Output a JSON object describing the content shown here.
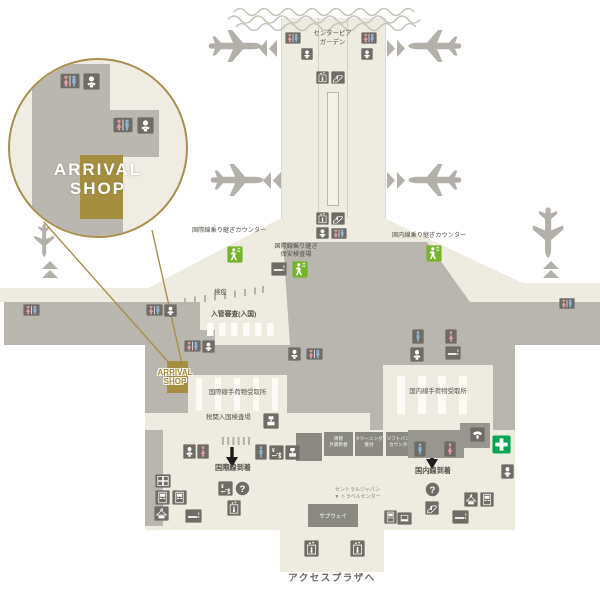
{
  "callout": {
    "shop_line1": "ARRIVAL",
    "shop_line2": "SHOP"
  },
  "map_shop_label": {
    "line1": "ARRIVAL",
    "line2": "SHOP"
  },
  "labels": {
    "center_pier_garden_1": "センターピア",
    "center_pier_garden_2": "ガーデン",
    "intl_transfer_counter": "国際線乗り継ぎカウンター",
    "intl_transfer_security_1": "国際線乗り継ぎ",
    "intl_transfer_security_2": "保安検査場",
    "dom_transfer_counter": "国内線乗り継ぎカウンター",
    "quarantine": "検疫",
    "immigration": "入管審査(入国)",
    "intl_baggage_claim": "国際線手荷物受取所",
    "dom_baggage_claim": "国内線手荷物受取所",
    "customs_inspection": "税関入国検査場",
    "intl_arrivals": "国際線到着",
    "dom_arrivals": "国内線到着",
    "central_japan_1": "セントラルジャパン",
    "central_japan_2": "▼ トラベルセンター",
    "access_plaza": "アクセスプラザへ"
  },
  "services": {
    "subway": "サブウェイ",
    "exchange_1": "両替",
    "exchange_2": "外貨両替",
    "cleaning_1": "クリーニング",
    "cleaning_2": "受付",
    "softbank_1": "ソフトバンク",
    "softbank_2": "カウンター"
  },
  "colors": {
    "accent_gold": "#a8904a",
    "terminal_cream": "#eeece1",
    "secure_gray": "#b8b6ae",
    "icon_gray": "#6e6c65",
    "service_box_gray": "#8b8a82",
    "walk_green": "#76b42c",
    "first_aid_green": "#00a651",
    "female_pink": "#e39aa6",
    "male_blue": "#8fb6d9",
    "label_text": "#55534b"
  },
  "map": {
    "icons": [
      {
        "name": "pier-left-restroom",
        "type": "restroom",
        "x": 285,
        "y": 31,
        "w": 16,
        "h": 14,
        "parent": "map"
      },
      {
        "name": "pier-left-baby",
        "type": "baby",
        "x": 301,
        "y": 48,
        "w": 12,
        "h": 12,
        "parent": "map"
      },
      {
        "name": "pier-right-restroom",
        "type": "restroom",
        "x": 361,
        "y": 31,
        "w": 16,
        "h": 14,
        "parent": "map"
      },
      {
        "name": "pier-right-baby",
        "type": "baby",
        "x": 361,
        "y": 48,
        "w": 12,
        "h": 12,
        "parent": "map"
      },
      {
        "name": "corridor-elevator-upper",
        "type": "elevator",
        "x": 316,
        "y": 71,
        "w": 13,
        "h": 13,
        "parent": "map"
      },
      {
        "name": "corridor-escalator-upper",
        "type": "escalator",
        "x": 331,
        "y": 71,
        "w": 14,
        "h": 13,
        "parent": "map"
      },
      {
        "name": "corridor-elevator-lower",
        "type": "elevator",
        "x": 316,
        "y": 212,
        "w": 13,
        "h": 13,
        "parent": "map"
      },
      {
        "name": "corridor-escalator-lower",
        "type": "escalator",
        "x": 331,
        "y": 212,
        "w": 14,
        "h": 13,
        "parent": "map"
      },
      {
        "name": "corridor-baby-lower",
        "type": "baby",
        "x": 316,
        "y": 227,
        "w": 13,
        "h": 12,
        "parent": "map"
      },
      {
        "name": "corridor-restroom-lower",
        "type": "restroom",
        "x": 331,
        "y": 227,
        "w": 16,
        "h": 13,
        "parent": "map"
      },
      {
        "name": "intl-transfer-walk",
        "type": "walk",
        "x": 227,
        "y": 246,
        "w": 16,
        "h": 17,
        "parent": "map"
      },
      {
        "name": "security-smoking",
        "type": "smoking",
        "x": 271,
        "y": 262,
        "w": 16,
        "h": 14,
        "parent": "map"
      },
      {
        "name": "security-walk",
        "type": "walk",
        "x": 292,
        "y": 261,
        "w": 16,
        "h": 17,
        "parent": "map"
      },
      {
        "name": "dom-transfer-walk",
        "type": "walk",
        "x": 426,
        "y": 245,
        "w": 16,
        "h": 17,
        "parent": "map"
      },
      {
        "name": "west-wing-restroom",
        "type": "restroom",
        "x": 23,
        "y": 303,
        "w": 17,
        "h": 14,
        "parent": "map"
      },
      {
        "name": "west-restroom-2",
        "type": "restroom",
        "x": 146,
        "y": 303,
        "w": 17,
        "h": 14,
        "parent": "map"
      },
      {
        "name": "west-baby",
        "type": "baby",
        "x": 164,
        "y": 304,
        "w": 13,
        "h": 13,
        "parent": "map"
      },
      {
        "name": "east-wing-restroom",
        "type": "restroom",
        "x": 559,
        "y": 297,
        "w": 16,
        "h": 13,
        "parent": "map"
      },
      {
        "name": "shop-restroom",
        "type": "restroom",
        "x": 184,
        "y": 339,
        "w": 17,
        "h": 14,
        "parent": "map"
      },
      {
        "name": "shop-baby",
        "type": "baby",
        "x": 202,
        "y": 340,
        "w": 13,
        "h": 13,
        "parent": "map"
      },
      {
        "name": "intl-bag-baby",
        "type": "baby",
        "x": 288,
        "y": 347,
        "w": 13,
        "h": 14,
        "parent": "map"
      },
      {
        "name": "intl-bag-restroom",
        "type": "restroom",
        "x": 306,
        "y": 347,
        "w": 17,
        "h": 14,
        "parent": "map"
      },
      {
        "name": "dom-bag-male",
        "type": "male",
        "x": 412,
        "y": 329,
        "w": 12,
        "h": 15,
        "parent": "map"
      },
      {
        "name": "dom-bag-female",
        "type": "female",
        "x": 445,
        "y": 329,
        "w": 12,
        "h": 15,
        "parent": "map"
      },
      {
        "name": "dom-bag-baby",
        "type": "baby",
        "x": 410,
        "y": 347,
        "w": 14,
        "h": 15,
        "parent": "map"
      },
      {
        "name": "dom-bag-smoking",
        "type": "smoking",
        "x": 445,
        "y": 346,
        "w": 16,
        "h": 14,
        "parent": "map"
      },
      {
        "name": "customs-stamp",
        "type": "customs",
        "x": 263,
        "y": 413,
        "w": 16,
        "h": 16,
        "parent": "map"
      },
      {
        "name": "customs-baby",
        "type": "baby",
        "x": 183,
        "y": 444,
        "w": 13,
        "h": 15,
        "parent": "map"
      },
      {
        "name": "customs-female",
        "type": "female",
        "x": 197,
        "y": 444,
        "w": 12,
        "h": 15,
        "parent": "map"
      },
      {
        "name": "arrivals-male",
        "type": "male",
        "x": 255,
        "y": 444,
        "w": 12,
        "h": 16,
        "parent": "map"
      },
      {
        "name": "arrivals-forex",
        "type": "forex",
        "x": 269,
        "y": 445,
        "w": 15,
        "h": 15,
        "parent": "map"
      },
      {
        "name": "arrivals-customs",
        "type": "customs",
        "x": 285,
        "y": 445,
        "w": 15,
        "h": 15,
        "parent": "map"
      },
      {
        "name": "dom-box-male",
        "type": "male",
        "x": 414,
        "y": 441,
        "w": 12,
        "h": 16,
        "parent": "map"
      },
      {
        "name": "dom-box-female",
        "type": "female",
        "x": 444,
        "y": 441,
        "w": 12,
        "h": 16,
        "parent": "map"
      },
      {
        "name": "public-phone",
        "type": "phone",
        "x": 470,
        "y": 427,
        "w": 15,
        "h": 15,
        "parent": "map"
      },
      {
        "name": "first-aid",
        "type": "firstaid",
        "x": 492,
        "y": 435,
        "w": 19,
        "h": 19,
        "parent": "map"
      },
      {
        "name": "dom-baby",
        "type": "baby",
        "x": 501,
        "y": 464,
        "w": 13,
        "h": 15,
        "parent": "map"
      },
      {
        "name": "intl-forex",
        "type": "forex",
        "x": 218,
        "y": 481,
        "w": 15,
        "h": 15,
        "parent": "map"
      },
      {
        "name": "intl-question",
        "type": "question",
        "x": 235,
        "y": 481,
        "w": 15,
        "h": 15,
        "parent": "map"
      },
      {
        "name": "intl-elevator",
        "type": "elevator",
        "x": 227,
        "y": 500,
        "w": 14,
        "h": 16,
        "parent": "map"
      },
      {
        "name": "dom-question",
        "type": "question",
        "x": 425,
        "y": 482,
        "w": 15,
        "h": 15,
        "parent": "map"
      },
      {
        "name": "dom-escalator",
        "type": "escalator",
        "x": 425,
        "y": 501,
        "w": 14,
        "h": 14,
        "parent": "map"
      },
      {
        "name": "cloak-east",
        "type": "cloak",
        "x": 464,
        "y": 492,
        "w": 14,
        "h": 15,
        "parent": "map"
      },
      {
        "name": "copy-east",
        "type": "vending",
        "x": 480,
        "y": 492,
        "w": 14,
        "h": 15,
        "parent": "map"
      },
      {
        "name": "smoking-east",
        "type": "smoking",
        "x": 452,
        "y": 510,
        "w": 17,
        "h": 14,
        "parent": "map"
      },
      {
        "name": "internet-laptop",
        "type": "laptop",
        "x": 397,
        "y": 512,
        "w": 15,
        "h": 13,
        "parent": "map"
      },
      {
        "name": "vending-east",
        "type": "vending",
        "x": 384,
        "y": 510,
        "w": 13,
        "h": 14,
        "parent": "map"
      },
      {
        "name": "lockers-west",
        "type": "lockers",
        "x": 155,
        "y": 474,
        "w": 16,
        "h": 14,
        "parent": "map"
      },
      {
        "name": "vending-west-1",
        "type": "vending",
        "x": 155,
        "y": 490,
        "w": 15,
        "h": 15,
        "parent": "map"
      },
      {
        "name": "vending-west-2",
        "type": "vending",
        "x": 172,
        "y": 490,
        "w": 15,
        "h": 15,
        "parent": "map"
      },
      {
        "name": "cloak-west",
        "type": "cloak",
        "x": 154,
        "y": 506,
        "w": 15,
        "h": 15,
        "parent": "map"
      },
      {
        "name": "smoking-west",
        "type": "smoking",
        "x": 185,
        "y": 509,
        "w": 17,
        "h": 14,
        "parent": "map"
      },
      {
        "name": "tongue-elevator-1",
        "type": "elevator",
        "x": 304,
        "y": 540,
        "w": 15,
        "h": 17,
        "parent": "map"
      },
      {
        "name": "tongue-elevator-2",
        "type": "elevator",
        "x": 350,
        "y": 540,
        "w": 15,
        "h": 17,
        "parent": "map"
      },
      {
        "name": "callout-restroom-1",
        "type": "restroom",
        "x": 50,
        "y": 12,
        "w": 20,
        "h": 18,
        "parent": "callout"
      },
      {
        "name": "callout-baby-1",
        "type": "baby",
        "x": 73,
        "y": 13,
        "w": 17,
        "h": 17,
        "parent": "callout"
      },
      {
        "name": "callout-restroom-2",
        "type": "restroom",
        "x": 103,
        "y": 56,
        "w": 20,
        "h": 18,
        "parent": "callout"
      },
      {
        "name": "callout-baby-2",
        "type": "baby",
        "x": 127,
        "y": 57,
        "w": 17,
        "h": 17,
        "parent": "callout"
      }
    ]
  }
}
